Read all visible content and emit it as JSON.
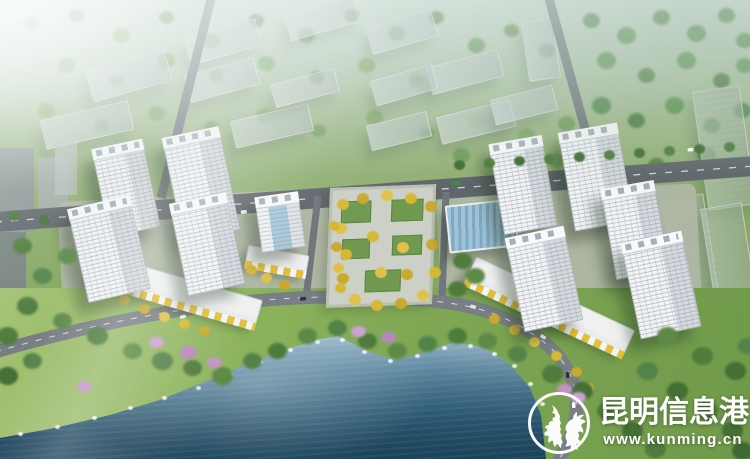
{
  "scene": {
    "type": "aerial-architectural-rendering",
    "subject": "lakefront residential development with high-rise towers, central plaza and waterfront park",
    "palette": {
      "water_deep": "#1c4158",
      "water_light": "#aecbdc",
      "grass": "#7fa754",
      "tree_green": "#4f7c3d",
      "tower_face": "#f1f3f5",
      "road_gray": "#5f656b",
      "plaza_tree_yellow": "#d6b835",
      "blossom_pink": "#c293c8",
      "awning_yellow": "#e4bf3a",
      "haze": "#e3ece8"
    }
  },
  "watermark": {
    "site_name": "昆明信息港",
    "site_url": "www.kunming.cn",
    "logo": "golden-horse-and-jade-rooster-emblem",
    "text_color": "#ffffff"
  }
}
